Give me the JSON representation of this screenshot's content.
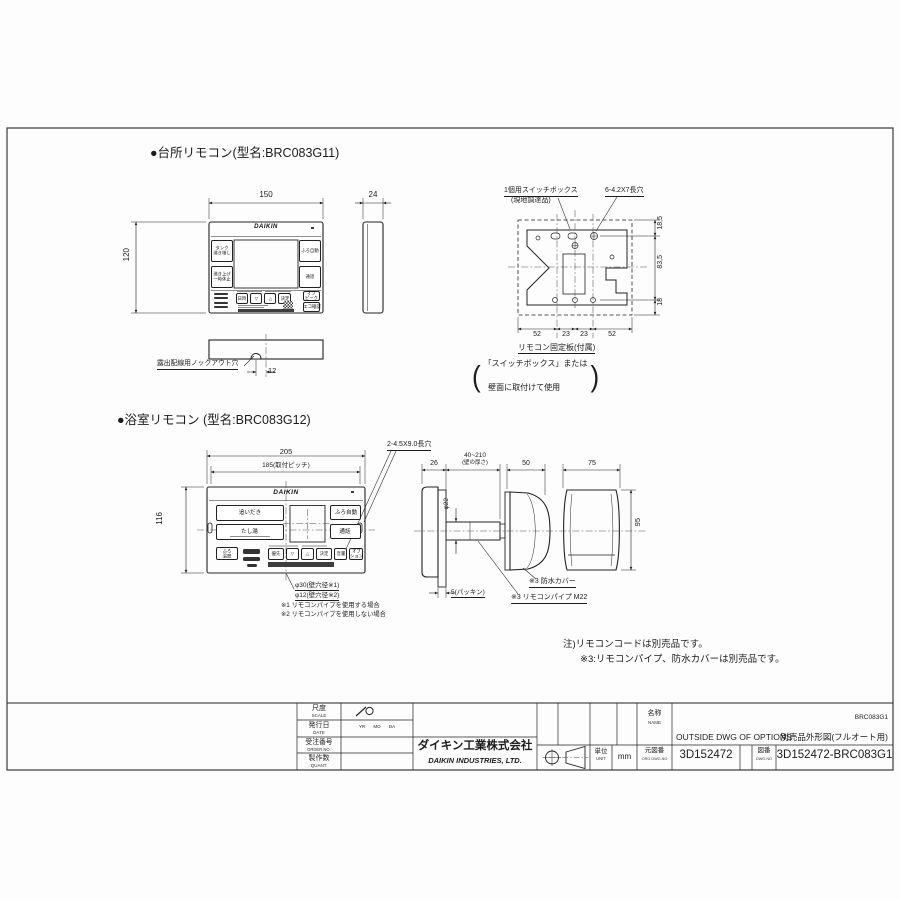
{
  "kitchen": {
    "label": "●台所リモコン(型名:BRC083G11)",
    "brand": "DAIKIN",
    "dim_w": "150",
    "dim_d": "24",
    "dim_h": "120",
    "dim_knock": "12",
    "knock_label": "露出配線用ノックアウト穴",
    "btn1": "タンク\n沸き増し",
    "btn2": "沸き上げ\n一時休止",
    "btn3": "ふろ自動",
    "btn4": "通話",
    "btn5": "日時",
    "btn6": "▽",
    "btn7": "△",
    "btn8": "決定",
    "btn9": "オフ\nピーク",
    "btn10": "エコ確認"
  },
  "switchbox": {
    "label1": "1個用スイッチボックス",
    "label2": "(現地調達品)",
    "slots": "6-4.2X7長穴",
    "d1": "18,5",
    "d2": "83,5",
    "d3": "18",
    "b1": "52",
    "b2": "23",
    "b3": "23",
    "b4": "52",
    "plate": "リモコン固定板(付属)",
    "paren_open": "(",
    "paren_close": ")",
    "use1": "「スイッチボックス」または",
    "use2": "壁面に取付けて使用"
  },
  "bath": {
    "label": "●浴室リモコン (型名:BRC083G12)",
    "brand": "DAIKIN",
    "dim_w": "205",
    "dim_pitch": "185(取付ピッチ)",
    "dim_h": "116",
    "slot": "2-4.5X9.0長穴",
    "btn1": "追いだき",
    "btn2": "たし湯",
    "btn3": "ふろ自動",
    "btn4": "通話",
    "btn5": "ふろ\n温度",
    "btn6": "優先",
    "btn7": "▽",
    "btn8": "△",
    "btn9": "決定",
    "btn10": "音量",
    "btn11": "オプ\nション",
    "hole1": "φ30(壁穴径※1)",
    "hole2": "φ12(壁穴径※2)",
    "note1": "※1 リモコンパイプを使用する場合",
    "note2": "※2 リモコンパイプを使用しない場合"
  },
  "side": {
    "dim_depth": "26",
    "dim_wall": "40~210",
    "dim_wall2": "(壁の厚さ)",
    "dim_cover_d": "50",
    "dim_cover_w": "75",
    "dim_pipe": "φ22",
    "dim_cover_h": "95",
    "packing": "5(パッキン)",
    "cover": "※3 防水カバー",
    "pipe": "※3 リモコンパイプ M22"
  },
  "notes": {
    "n1": "注)リモコンコードは別売品です。",
    "n2": "※3:リモコンパイプ、防水カバーは別売品です。"
  },
  "tb": {
    "scale_jp": "尺度",
    "scale_en": "SCALE",
    "date_jp": "発行日",
    "date_en": "DATE",
    "date_val": "YR MO DA",
    "order_jp": "受注番号",
    "order_en": "ORDER NO.",
    "qty_jp": "製作数",
    "qty_en": "QUANT.",
    "company_jp": "ダイキン工業株式会社",
    "company_en": "DAIKIN INDUSTRIES, LTD.",
    "unit_jp": "単位",
    "unit_en": "UNIT",
    "unit_val": "mm",
    "name_jp": "名称",
    "name_en": "NAME",
    "model": "BRC083G1",
    "title_en": "OUTSIDE DWG OF OPTIONS",
    "title_jp": "別売品外形図(フルオート用)",
    "org_jp": "元図番",
    "org_en": "ORG DWG.NO",
    "org_val": "3D152472",
    "dwg_jp": "図番",
    "dwg_en": "DWG.NO",
    "dwg_val": "3D152472-BRC083G1"
  }
}
